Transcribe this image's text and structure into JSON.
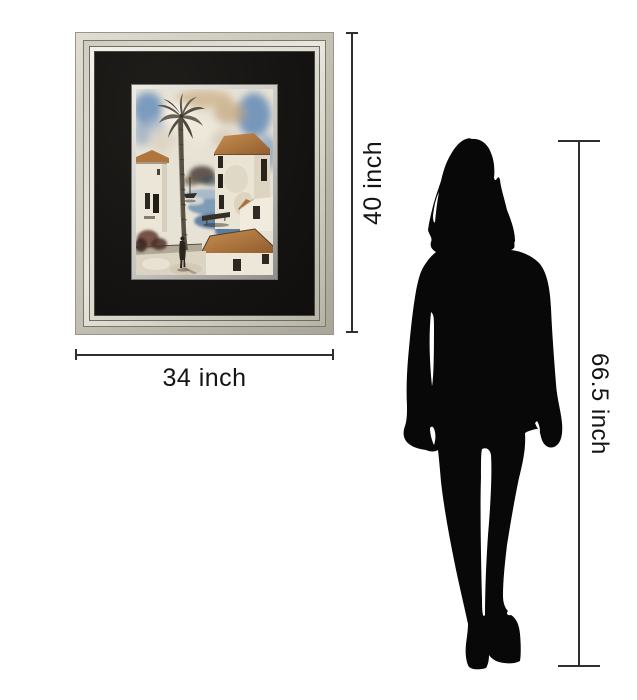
{
  "dimensions": {
    "frame_height": {
      "label": "40 inch"
    },
    "frame_width": {
      "label": "34 inch"
    },
    "person_height": {
      "label": "66.5 inch"
    }
  },
  "artwork": {
    "frame_finish_color": "#cbc8bc",
    "mat_color": "#171513",
    "fillet_color": "#c6c5c0",
    "painting_theme": {
      "sky_blue": "#6f93bb",
      "cloud_beige": "#cdb38c",
      "roof_orange": "#b5773e",
      "wall_white": "#ebe6d8",
      "water_blue": "#54799f",
      "palm_brown": "#575042"
    }
  },
  "person": {
    "silhouette_color": "#080808"
  },
  "style": {
    "background": "#ffffff",
    "dimension_line_color": "#2f2f2f",
    "label_text_color": "#141414"
  }
}
